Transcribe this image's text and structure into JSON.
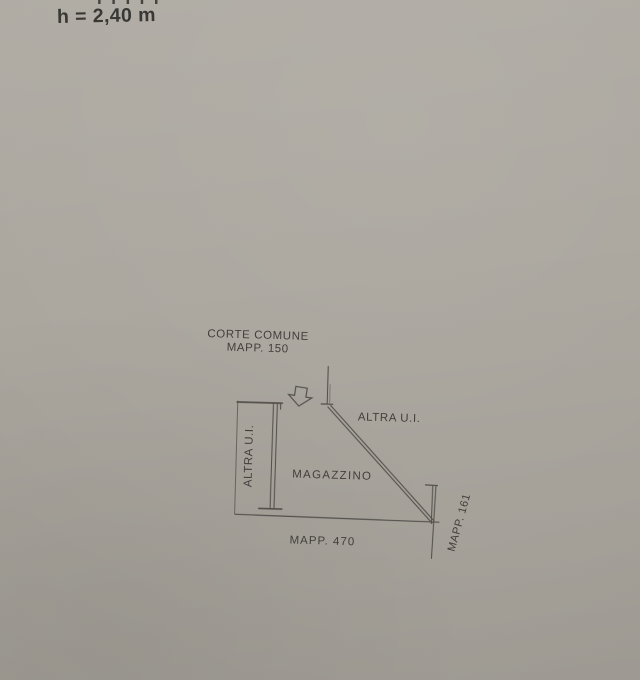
{
  "colors": {
    "paper": "#aba79f",
    "line": "#53514c",
    "boundary_line": "#67645e",
    "text": "#393734",
    "header_text": "#32312e"
  },
  "header": {
    "clipped_text": "IIIII",
    "height_label": "h = 2,40 m"
  },
  "plan": {
    "area_top_label_line1": "CORTE COMUNE",
    "area_top_label_line2": "MAPP. 150",
    "left_unit_label": "ALTRA U.I.",
    "right_unit_label": "ALTRA U.I.",
    "room_label": "MAGAZZINO",
    "bottom_parcel_label": "MAPP. 470",
    "right_parcel_label": "MAPP. 161",
    "entrance_arrow_icon": "down-block-arrow"
  }
}
